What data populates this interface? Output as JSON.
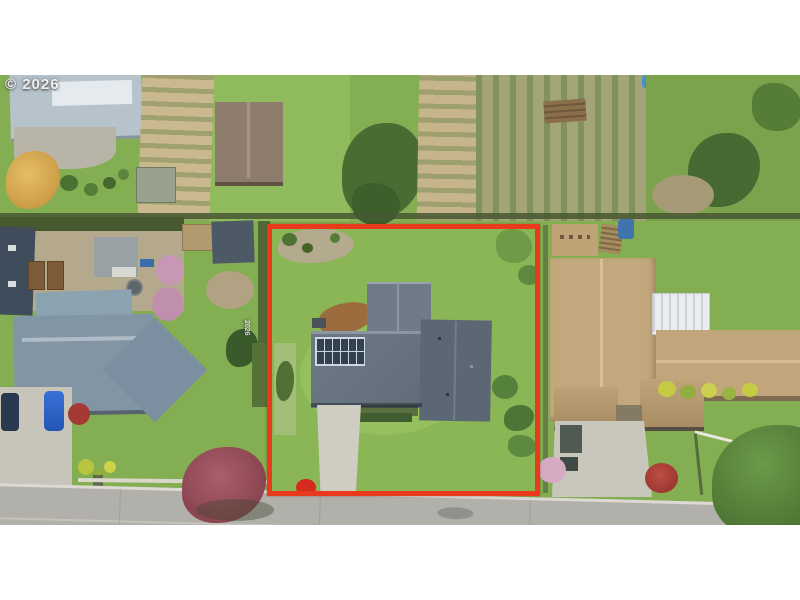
{
  "watermark": {
    "text": "© 2026"
  },
  "side_watermark": {
    "text": "2026"
  },
  "palette": {
    "letterbox": "#ffffff",
    "boundary_red": "#e93a1d",
    "grass": "#84ae52",
    "lawn_bright": "#8fbb5d",
    "street_gray": "#b2b0aa",
    "curb_light": "#dcdad2",
    "subject_roof": "#67737f",
    "subject_garage_roof": "#5b6775",
    "solar_panel_dark": "#32414f",
    "left_neighbor_roof": "#8295a4",
    "right_neighbor_roof": "#c3a87d",
    "driveway_concrete": "#cfccc1",
    "maple_tree_red": "#9b4e59",
    "gold_tree": "#dfb057"
  }
}
